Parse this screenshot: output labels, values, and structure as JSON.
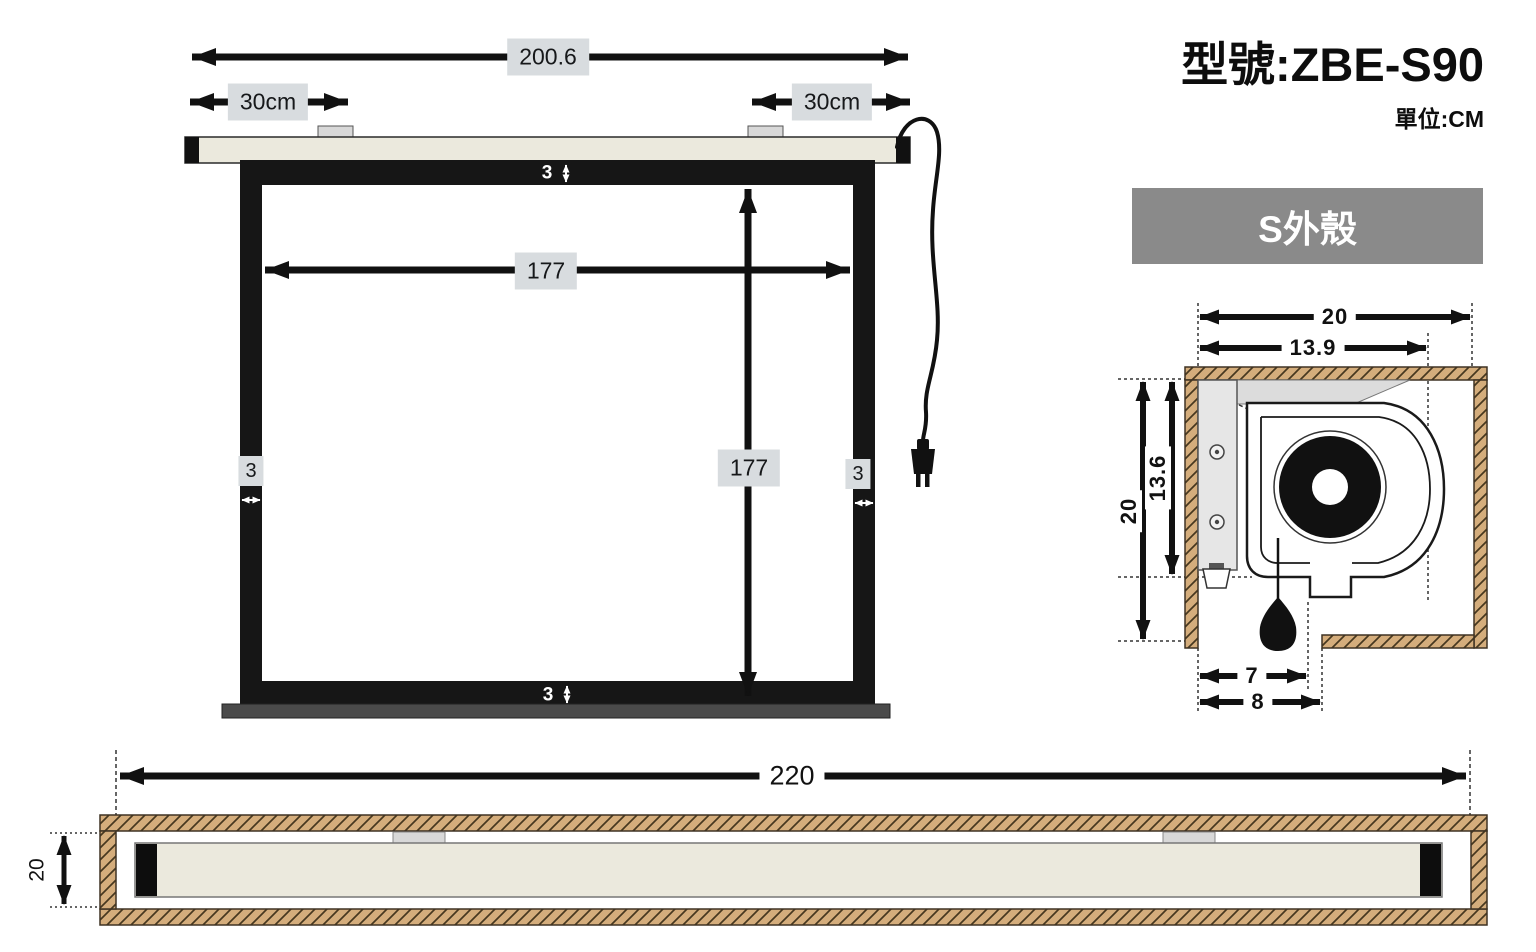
{
  "header": {
    "model": "型號:ZBE-S90",
    "unit": "單位:CM"
  },
  "banner": {
    "label": "S外殼"
  },
  "front_view": {
    "total_width": "200.6",
    "offset_left": "30cm",
    "offset_right": "30cm",
    "border_top": "3",
    "inner_width": "177",
    "inner_height": "177",
    "border_left": "3",
    "border_right": "3",
    "border_bottom": "3"
  },
  "section_view": {
    "outer_width": "20",
    "inner_width": "13.9",
    "outer_height": "20",
    "inner_height": "13.6",
    "opening_inner": "7",
    "opening_outer": "8"
  },
  "side_view": {
    "total_length": "220",
    "height": "20"
  },
  "colors": {
    "label_bg": "#d8dcdf",
    "banner_bg": "#8a8a8a",
    "banner_text": "#ffffff",
    "wood_fill": "#d4ad7c",
    "hatch_line": "#47381f",
    "casing_fill": "#ebe9dd",
    "frame_black": "#161616",
    "slat_gray": "#4a4a4a",
    "panel_gray": "#dcdcdc",
    "line_black": "#1a1a1a"
  }
}
